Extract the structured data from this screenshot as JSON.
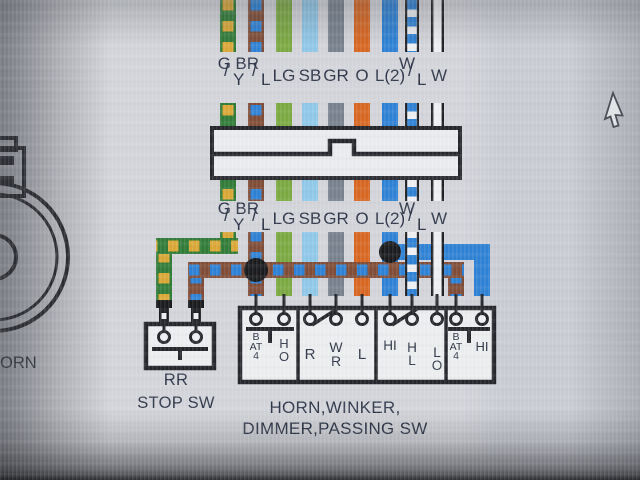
{
  "slash": "/",
  "wire_labels": [
    {
      "main": "G",
      "sub": "Y",
      "color_code": "green/yellow"
    },
    {
      "main": "BR",
      "sub": "L",
      "color_code": "brown/blue"
    },
    {
      "main": "LG",
      "color_code": "light green"
    },
    {
      "main": "SB",
      "color_code": "sky blue"
    },
    {
      "main": "GR",
      "color_code": "gray"
    },
    {
      "main": "O",
      "color_code": "orange"
    },
    {
      "main": "L(2)",
      "color_code": "blue"
    },
    {
      "main": "W",
      "sub": "L",
      "color_code": "white/blue"
    },
    {
      "main": "W",
      "color_code": "white"
    }
  ],
  "wire_colors": {
    "green": "#2e7a35",
    "yellow": "#dba733",
    "brown": "#7e4a34",
    "blue": "#2b80d5",
    "light_green": "#7aa93f",
    "sky_blue": "#8fc8e9",
    "gray": "#76808c",
    "orange": "#d8651f",
    "white": "#eef0f3",
    "black": "#1d1f23"
  },
  "switch_assembly": {
    "caption_line1": "HORN,WINKER,",
    "caption_line2": "DIMMER,PASSING SW",
    "sections": [
      {
        "terminals": [
          "BAT4",
          "HO"
        ]
      },
      {
        "terminals": [
          "R",
          "WR",
          "L"
        ]
      },
      {
        "terminals": [
          "HI",
          "HL",
          "LO"
        ]
      },
      {
        "terminals": [
          "BAT4",
          "HI"
        ]
      }
    ]
  },
  "rr_stop_switch": {
    "caption_line1": "RR",
    "caption_line2": "STOP SW"
  },
  "horn": {
    "partial_label": "ORN"
  }
}
